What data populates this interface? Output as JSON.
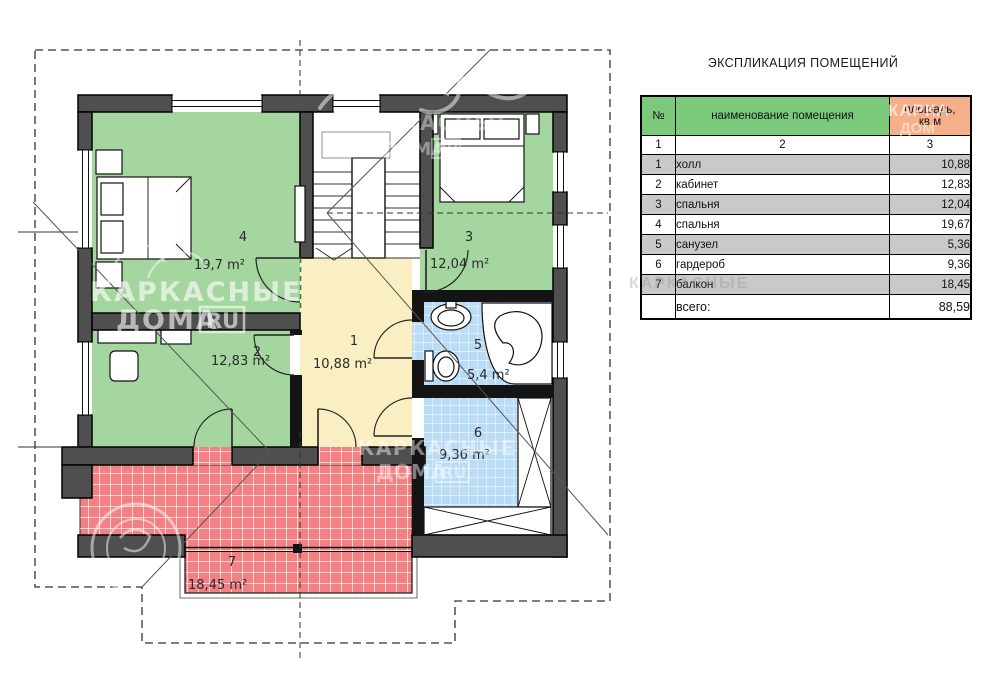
{
  "title": "ЭКСПЛИКАЦИЯ ПОМЕЩЕНИЙ",
  "floor_plan": {
    "rooms": [
      {
        "number": "1",
        "name": "холл",
        "area": "10,88",
        "area_label": "10,88 m²"
      },
      {
        "number": "2",
        "name": "кабинет",
        "area": "12,83",
        "area_label": "12,83 m²"
      },
      {
        "number": "3",
        "name": "спальня",
        "area": "12,04",
        "area_label": "12,04 m²"
      },
      {
        "number": "4",
        "name": "спальня",
        "area": "19,67",
        "area_label": "19,7 m²"
      },
      {
        "number": "5",
        "name": "санузел",
        "area": "5,36",
        "area_label": "5,4 m²"
      },
      {
        "number": "6",
        "name": "гардероб",
        "area": "9,36",
        "area_label": "9,36 m²"
      },
      {
        "number": "7",
        "name": "балкон",
        "area": "18,45",
        "area_label": "18,45 m²"
      }
    ],
    "colors": {
      "room_green": "#a5d6a0",
      "hall_yellow": "#f9efc3",
      "wet_blue": "#b9dbf6",
      "balcony_red": "#f38183",
      "wall": "#4f4f4f",
      "header_green": "#7bc97b",
      "header_orange": "#f6b089",
      "row_gray": "#c9c9c9"
    },
    "watermark": {
      "brand_line1": "КАРКАСНЫЕ",
      "brand_line2": "ДОМА",
      "brand_badge": "RU",
      "table_overlay_line1": "КАРКА",
      "table_overlay_line2": "ДОМ"
    }
  },
  "legend_table": {
    "col_no": "№",
    "col_name": "наименование помещения",
    "col_area_line1": "площадь,",
    "col_area_line2": "кв.м",
    "column_numbers": [
      "1",
      "2",
      "3"
    ],
    "total_label": "всего:",
    "total_value": "88,59"
  }
}
